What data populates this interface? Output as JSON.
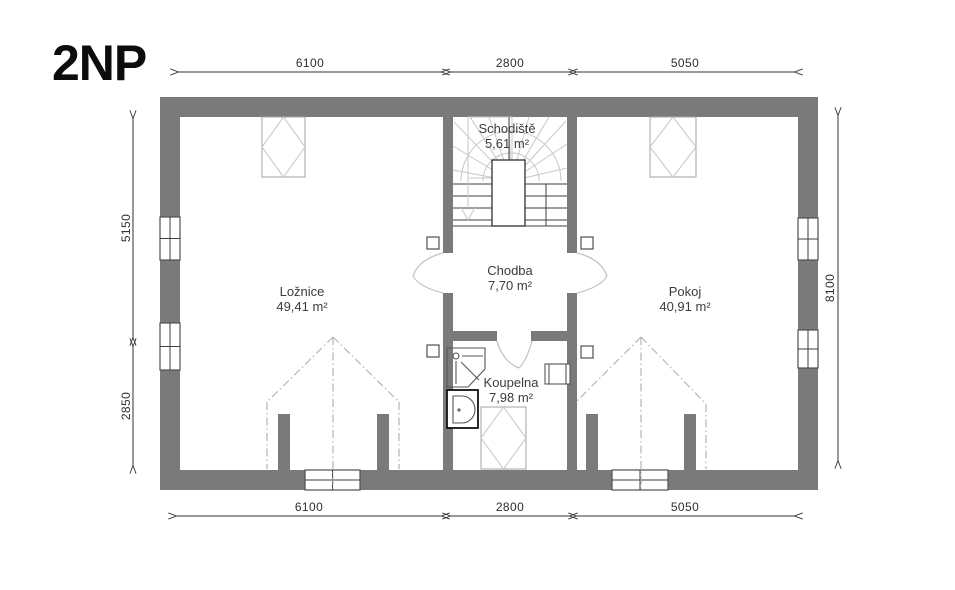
{
  "title": "2NP",
  "rooms": {
    "schodiste": {
      "name": "Schodiště",
      "area": "5,61 m²"
    },
    "chodba": {
      "name": "Chodba",
      "area": "7,70 m²"
    },
    "loznice": {
      "name": "Ložnice",
      "area": "49,41 m²"
    },
    "pokoj": {
      "name": "Pokoj",
      "area": "40,91 m²"
    },
    "koupelna": {
      "name": "Koupelna",
      "area": "7,98 m²"
    }
  },
  "dimensions": {
    "top": [
      "6100",
      "2800",
      "5050"
    ],
    "bottom": [
      "6100",
      "2800",
      "5050"
    ],
    "left": [
      "5150",
      "2850"
    ],
    "right": [
      "8100"
    ]
  },
  "colors": {
    "wall": "#7a7a7a",
    "text": "#3c3c3c"
  }
}
